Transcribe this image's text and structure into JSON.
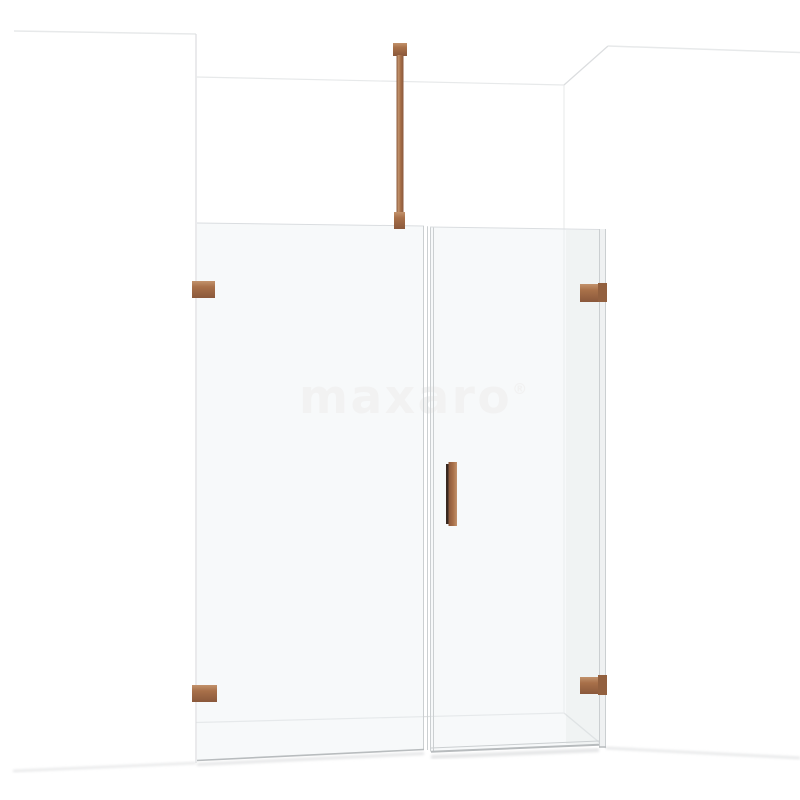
{
  "watermark": {
    "text": "maxaro",
    "registered_mark": "®"
  },
  "colors": {
    "background": "#ffffff",
    "watermark": "#f2f2f2",
    "glass_tint": "rgba(238,242,244,0.45)",
    "glass_fill_edge_panel": "#eff1f2",
    "wall_shade": "rgba(203,209,213,0.16)",
    "wall_line": "#e7e9ea",
    "wall_line_soft": "#eceff0",
    "corner_line": "#dbdddf",
    "floor_line": "#e0e2e3",
    "glass_edge": "#cbcfd1",
    "glass_edge_light": "#dadde0",
    "frame_bottom": "#b7bbbd",
    "shadow": "#e5e6e7",
    "copper": "#a87049",
    "copper_light": "#c2926c",
    "copper_dark": "#8a583b",
    "copper_shade": "#92603f",
    "handle_edge": "#382820"
  }
}
